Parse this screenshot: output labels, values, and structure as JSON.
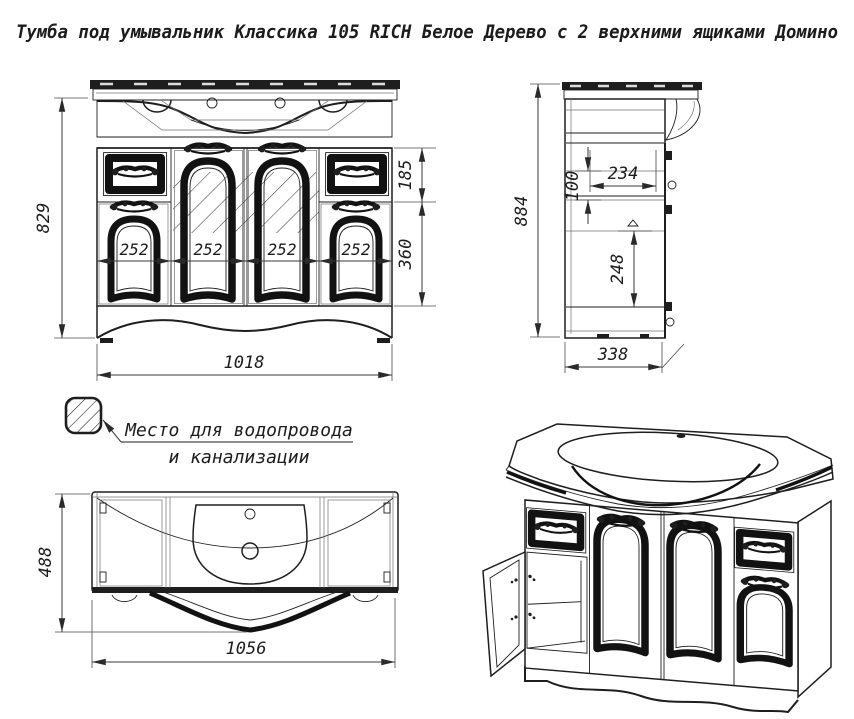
{
  "title": "Тумба под умывальник Классика 105 RICH Белое Дерево с 2 верхними ящиками Домино",
  "front_view": {
    "height": "829",
    "width": "1018",
    "top_drawer_height": "185",
    "door_height": "360",
    "panel_widths": [
      "252",
      "252",
      "252",
      "252"
    ]
  },
  "side_view": {
    "height": "884",
    "depth": "338",
    "inner_width": "234",
    "inner_gap": "100",
    "inner_height": "248"
  },
  "plan_view": {
    "depth": "488",
    "width": "1056"
  },
  "legend": {
    "note_line1": "Место для водопровода",
    "note_line2": "и канализации"
  },
  "colors": {
    "line": "#1e1e1e",
    "background": "#ffffff"
  }
}
